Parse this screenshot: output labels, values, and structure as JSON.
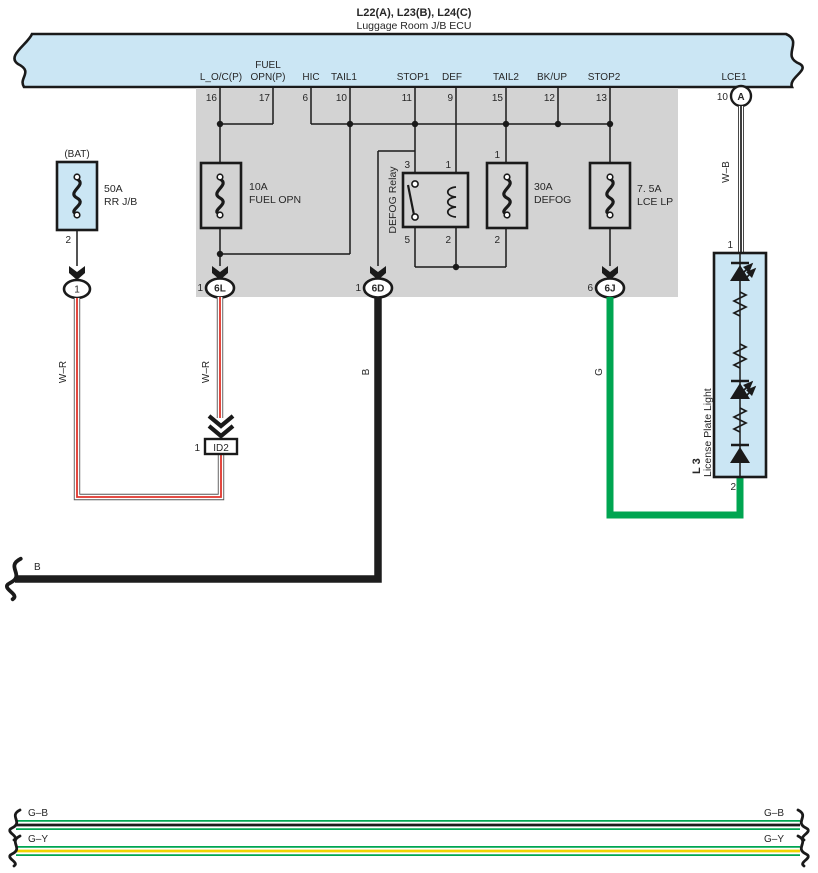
{
  "header": {
    "title": "L22(A), L23(B), L24(C)",
    "subtitle": "Luggage Room J/B ECU"
  },
  "ecu": {
    "pins": [
      {
        "label": "L_O/C(P)",
        "pin": "16"
      },
      {
        "label": "FUEL",
        "label2": "OPN(P)",
        "pin": "17"
      },
      {
        "label": "HIC",
        "pin": "6"
      },
      {
        "label": "TAIL1",
        "pin": "10"
      },
      {
        "label": "STOP1",
        "pin": "11"
      },
      {
        "label": "DEF",
        "pin": "9"
      },
      {
        "label": "TAIL2",
        "pin": "15"
      },
      {
        "label": "BK/UP",
        "pin": "12"
      },
      {
        "label": "STOP2",
        "pin": "13"
      }
    ],
    "lce1": {
      "label": "LCE1",
      "pin": "10",
      "connector": "A"
    }
  },
  "bat_fuse": {
    "label": "(BAT)",
    "rating": "50A",
    "name": "RR J/B",
    "pin": "2",
    "connector": "1"
  },
  "fuses": {
    "fuel": {
      "rating": "10A",
      "name": "FUEL OPN"
    },
    "defog": {
      "rating": "30A",
      "name": "DEFOG",
      "pin_top": "1",
      "pin_bottom": "2"
    },
    "lce": {
      "rating": "7. 5A",
      "name": "LCE LP"
    }
  },
  "relay": {
    "name": "DEFOG Relay",
    "pin_tl": "3",
    "pin_tr": "1",
    "pin_bl": "5",
    "pin_br": "2"
  },
  "connectors": {
    "c6l": {
      "pin": "1",
      "id": "6L"
    },
    "c6d": {
      "pin": "1",
      "id": "6D"
    },
    "c6j": {
      "pin": "6",
      "id": "6J"
    }
  },
  "id2": {
    "pin": "1",
    "id": "ID2"
  },
  "license_light": {
    "code": "L 3",
    "name": "License Plate Light",
    "pin_top": "1",
    "pin_bottom": "2"
  },
  "wires": {
    "w_r": "W–R",
    "w_b": "W–B",
    "b": "B",
    "g": "G",
    "g_b": "G–B",
    "g_y": "G–Y"
  },
  "colors": {
    "band_blue": "#cbe6f4",
    "panel_gray": "#d3d3d3",
    "green": "#00a551",
    "red": "#e0342b",
    "yellow": "#f0d500",
    "wire_black": "#1d1d1d"
  }
}
